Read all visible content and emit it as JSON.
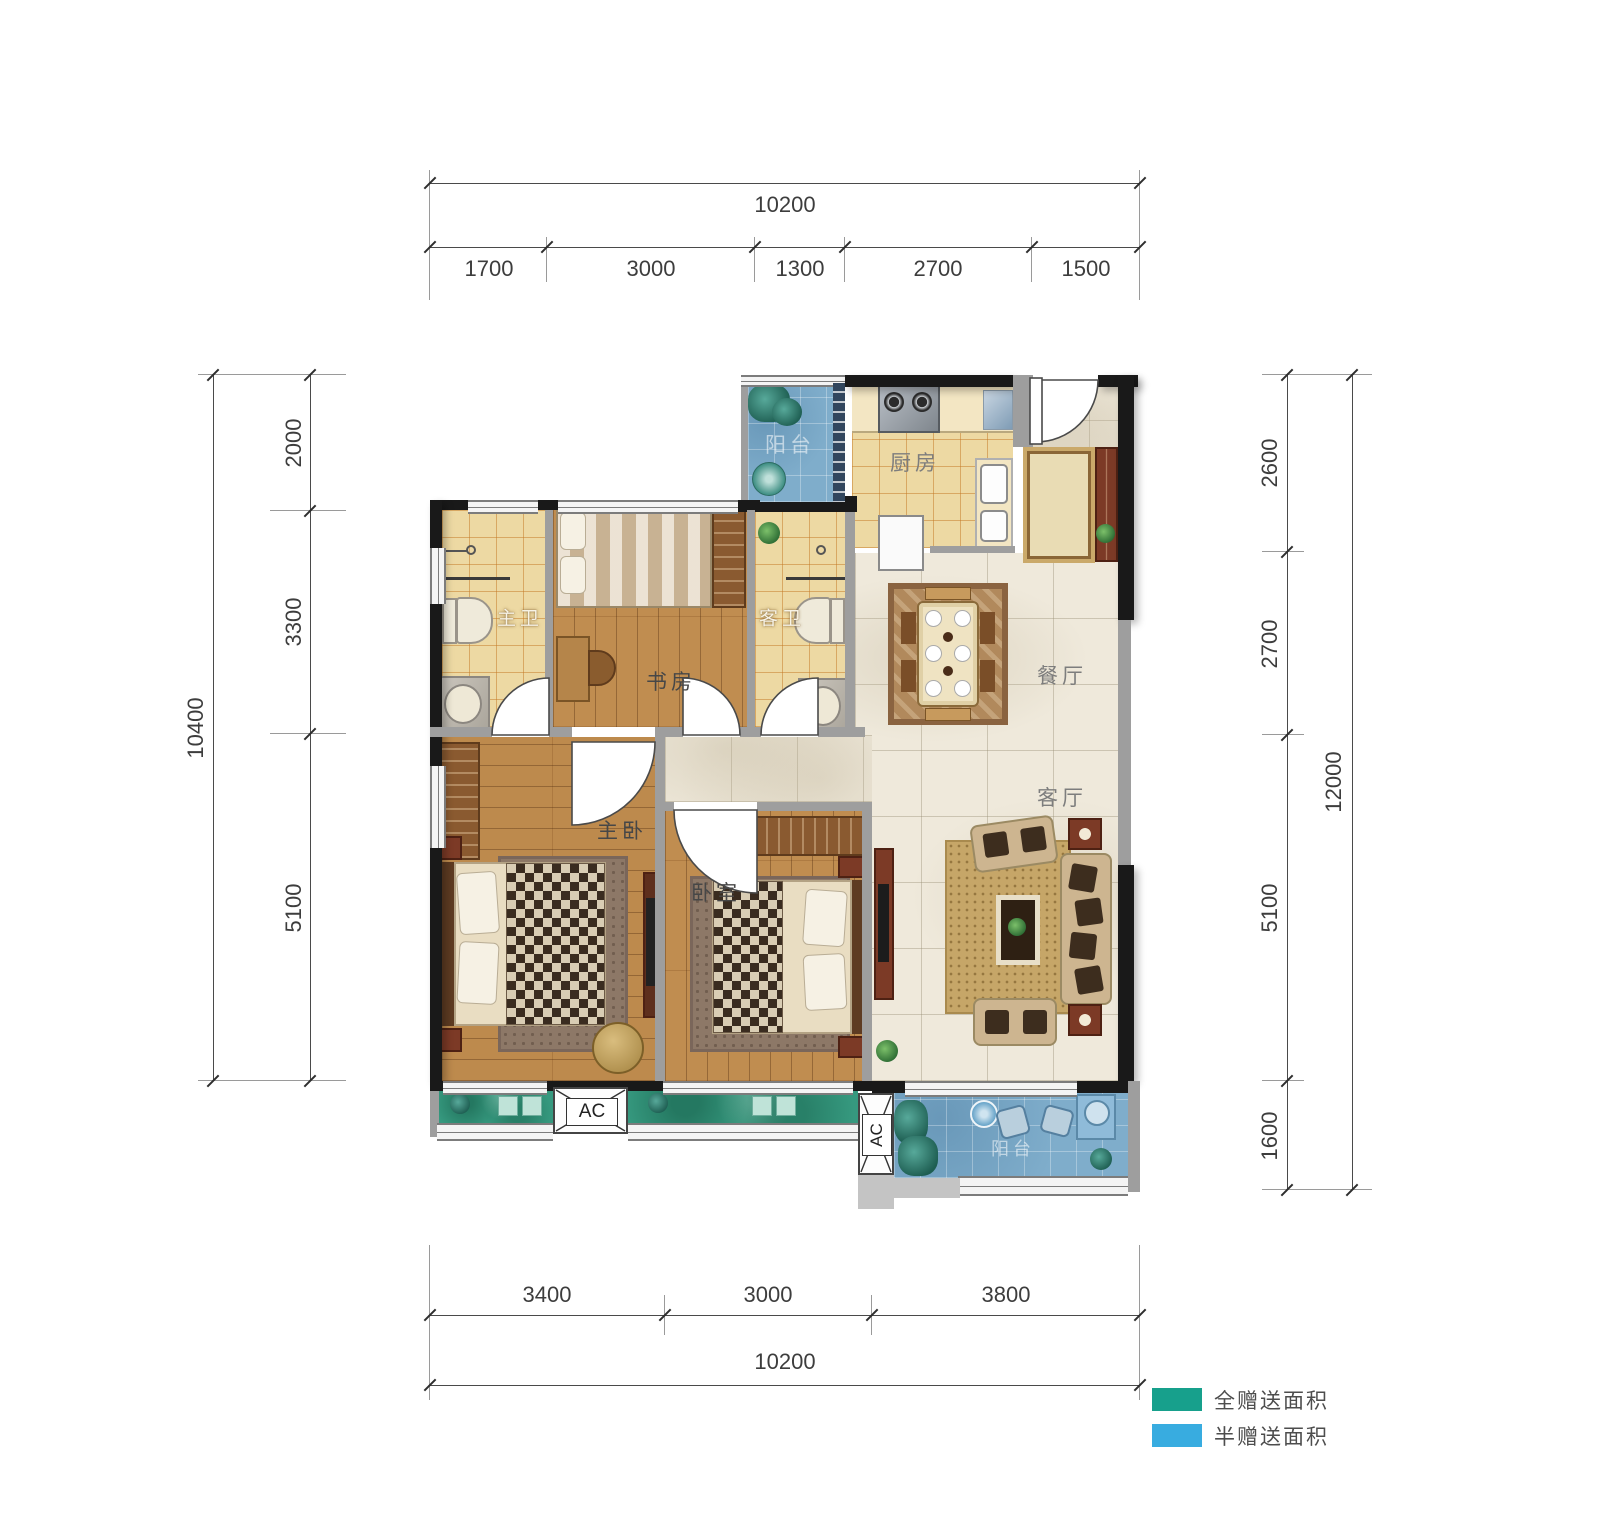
{
  "plan": {
    "rooms": {
      "balcony_top": "阳台",
      "kitchen": "厨房",
      "master_bath": "主卫",
      "study": "书房",
      "guest_bath": "客卫",
      "dining": "餐厅",
      "living": "客厅",
      "master_bedroom": "主卧",
      "bedroom": "卧室",
      "balcony_bottom": "阳台",
      "ac": "AC"
    }
  },
  "dimensions": {
    "top": {
      "total": "10200",
      "segments": [
        "1700",
        "3000",
        "1300",
        "2700",
        "1500"
      ]
    },
    "bottom": {
      "total": "10200",
      "segments": [
        "3400",
        "3000",
        "3800"
      ]
    },
    "left": {
      "total": "10400",
      "segments": [
        "2000",
        "3300",
        "5100"
      ]
    },
    "right": {
      "total": "12000",
      "segments": [
        "2600",
        "2700",
        "5100",
        "1600"
      ]
    }
  },
  "legend": {
    "items": [
      {
        "label": "全赠送面积",
        "color": "#17a08c"
      },
      {
        "label": "半赠送面积",
        "color": "#38ace0"
      }
    ]
  }
}
